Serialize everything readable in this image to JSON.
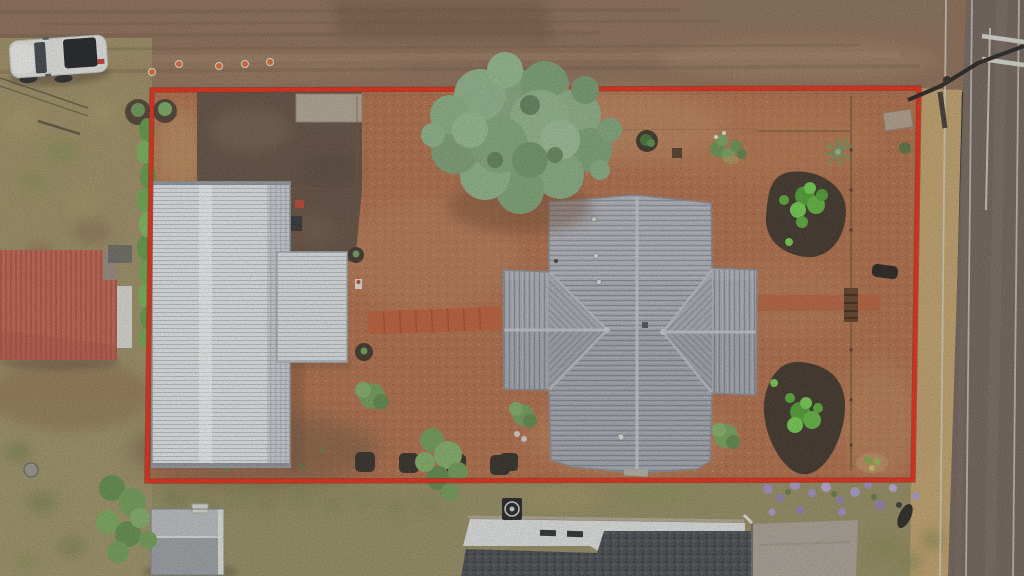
{
  "scene": {
    "type": "aerial-drone-photograph",
    "subject": "top-down view of a residential property outlined with a red boundary overlay",
    "orientation": "top-down"
  },
  "colors": {
    "boundary_red": "#ee220b",
    "lot_gravel": "#b26b44",
    "top_road": "#8c6b53",
    "side_road": "#6e6057",
    "dry_grass": "#9c8d60",
    "dark_dirt": "#5e4a3c",
    "white_roof": "#e7eaed",
    "house_roof": "#a9adb6",
    "red_roof": "#c5604d",
    "shingle_roof": "#43464c",
    "mulch": "#392d23",
    "tree_green": "#84aa7e",
    "yellow_gravel": "#c4a269",
    "concrete": "#aba295",
    "flower_purple": "#9d8fc0",
    "plant_bright": "#5db53a"
  },
  "annotations": {
    "boundary": {
      "color": "#ee220b",
      "corners": [
        [
          152,
          90
        ],
        [
          919,
          88
        ],
        [
          913,
          480
        ],
        [
          147,
          481
        ]
      ]
    }
  },
  "objects": {
    "vehicle": "white pickup truck parked on top road",
    "main_house": "gray metal cross hip roof house",
    "outbuilding": "long white metal roof garage with side awning",
    "neighbor_left": "salmon red metal roof building",
    "neighbor_bottom": "charcoal shingle roof house with white eave and concrete driveway",
    "shed": "small gray garden shed bottom-left",
    "tree": "large sage-green tree at top center",
    "garden_beds": "two dark mulch kidney beds with bright green shrubs",
    "landscaping": [
      "flagstone path",
      "row of four dark hedges",
      "purple flowering groundcover",
      "green hedge along left boundary",
      "orange traffic cones"
    ],
    "power_lines": "utility pole, crossarm and overhead lines at top right"
  }
}
